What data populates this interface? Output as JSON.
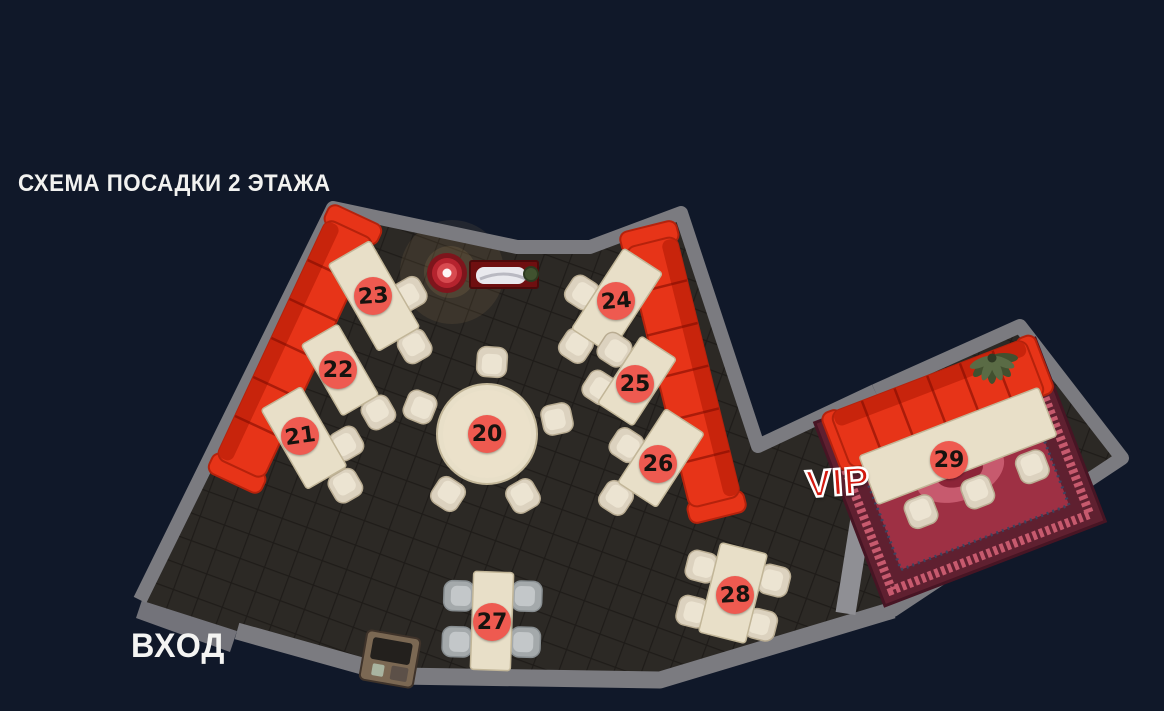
{
  "title": "СХЕМА ПОСАДКИ 2 ЭТАЖА",
  "labels": {
    "entrance": "ВХОД",
    "vip": "VIP"
  },
  "tables": [
    {
      "number": "20",
      "area": "main hall",
      "seats": 5
    },
    {
      "number": "21",
      "area": "main hall",
      "seats": 2
    },
    {
      "number": "22",
      "area": "main hall",
      "seats": 1
    },
    {
      "number": "23",
      "area": "main hall",
      "seats": 2
    },
    {
      "number": "24",
      "area": "main hall",
      "seats": 2
    },
    {
      "number": "25",
      "area": "main hall",
      "seats": 2
    },
    {
      "number": "26",
      "area": "main hall",
      "seats": 2
    },
    {
      "number": "27",
      "area": "main hall",
      "seats": 4
    },
    {
      "number": "28",
      "area": "main hall",
      "seats": 4
    },
    {
      "number": "29",
      "area": "vip",
      "seats": 3
    }
  ],
  "colors": {
    "background": "#101829",
    "wall": "#7b7b80",
    "wall_dark": "#55555a",
    "floor": "#2c2925",
    "floor_line": "#1f1c19",
    "sofa": "#e73418",
    "sofa_dark": "#b5220c",
    "sofa_back": "#c8240c",
    "table": "#e8dfc8",
    "table_edge": "#c2b698",
    "chair": "#dcd2bf",
    "chair_seat": "#ece4d2",
    "chair_edge": "#b9ac92",
    "chair_gray": "#a4a9ab",
    "chair_gray_seat": "#c3c7c9",
    "chair_gray_edge": "#878d90",
    "badge": "#ee5a50",
    "badge_text": "#17130f",
    "carpet": "#9e3044",
    "carpet_dark": "#5f2030",
    "carpet_light": "#c75a6e",
    "title_text": "#f2f2f0",
    "vip_text": "#d21a10",
    "entrance_text": "#f4f4f2"
  }
}
